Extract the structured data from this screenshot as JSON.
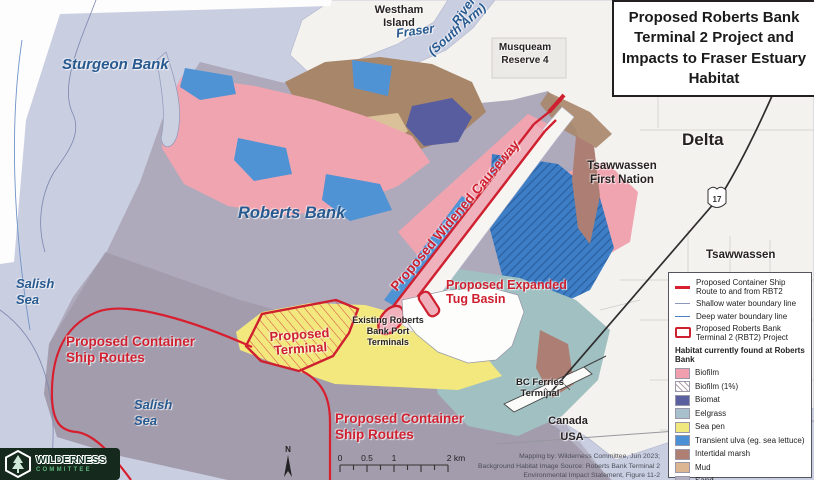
{
  "title": "Proposed Roberts Bank Terminal 2 Project and Impacts to Fraser Estuary Habitat",
  "map_labels": {
    "sturgeon_bank": "Sturgeon Bank",
    "westham_island": "Westham Island",
    "fraser": "Fraser",
    "river": "River",
    "south_arm": "(South Arm)",
    "musqueam": "Musqueam Reserve 4",
    "delta": "Delta",
    "tsawwassen_first_nation": "Tsawwassen First Nation",
    "tsawwassen": "Tsawwassen",
    "roberts_bank": "Roberts Bank",
    "widened_causeway": "Proposed Widened Causeway",
    "tug_basin": "Proposed Expanded Tug Basin",
    "existing_terminals": "Existing Roberts Bank Port Terminals",
    "proposed_terminal": "Proposed Terminal",
    "ship_routes_1": "Proposed Container Ship Routes",
    "ship_routes_2": "Proposed Container Ship Routes",
    "salish_sea_1": "Salish Sea",
    "salish_sea_2": "Salish Sea",
    "bc_ferries": "BC Ferries Terminal",
    "canada": "Canada",
    "usa": "USA",
    "highway_number": "17",
    "north": "N"
  },
  "legend": {
    "lines": [
      {
        "label": "Proposed Container Ship Route to and from RBT2",
        "color": "#d71f2f"
      },
      {
        "label": "Shallow water boundary line",
        "color": "#8d97bb"
      },
      {
        "label": "Deep water boundary line",
        "color": "#4a7fc1"
      },
      {
        "label": "Proposed Roberts Bank Terminal 2 (RBT2) Project",
        "color": "#cf2030"
      }
    ],
    "habitat_heading": "Habitat currently found at Roberts Bank",
    "habitats": [
      {
        "label": "Biofilm",
        "color": "#ef9fae"
      },
      {
        "label": "Biofilm (1%)",
        "color": "#ffffff"
      },
      {
        "label": "Biomat",
        "color": "#5a5fa0"
      },
      {
        "label": "Eelgrass",
        "color": "#a7c0cc"
      },
      {
        "label": "Sea pen",
        "color": "#f1e87d"
      },
      {
        "label": "Transient ulva (eg. sea lettuce)",
        "color": "#4b90d5"
      },
      {
        "label": "Intertidal marsh",
        "color": "#b07f74"
      },
      {
        "label": "Mud",
        "color": "#dcb693"
      },
      {
        "label": "Sand",
        "color": "#b2afc0"
      }
    ]
  },
  "scale_bar": {
    "labels": [
      "0",
      "0.5",
      "1",
      "2 km"
    ]
  },
  "credits": {
    "line1": "Mapping by: Wilderness Committee, Jun 2023;",
    "line2": "Background Habitat Image Source: Roberts Bank Terminal 2",
    "line3": "Environmental Impact Statement, Figure 11-2"
  },
  "logo": {
    "line1": "WILDERNESS",
    "line2": "COMMITTEE"
  }
}
